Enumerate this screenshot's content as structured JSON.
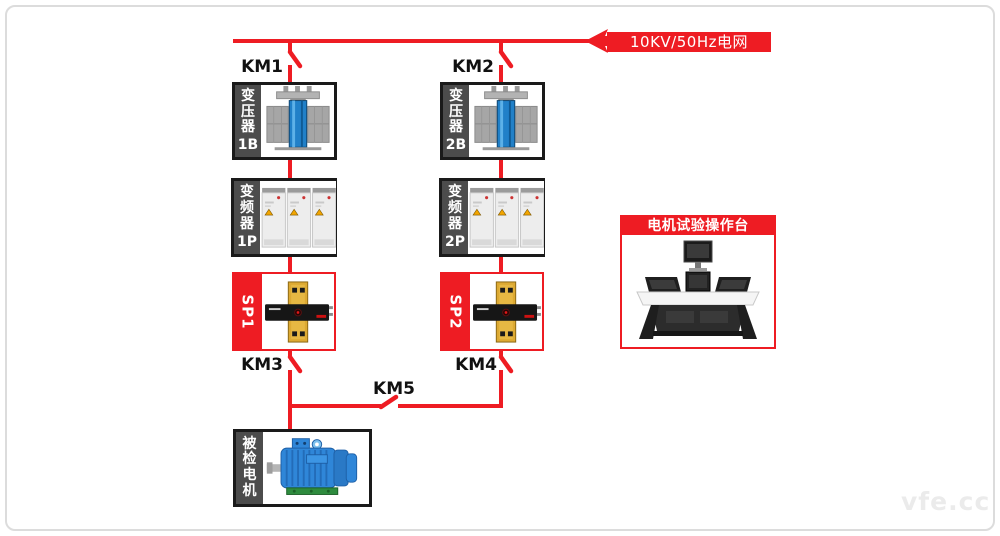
{
  "colors": {
    "accent_red": "#ee1c23",
    "box_border_dark": "#1a1a1a",
    "sidebar_gray": "#4c4c4c"
  },
  "grid_source": {
    "label": "10KV/50Hz电网"
  },
  "branches": [
    {
      "breaker_top": "KM1",
      "transformer": {
        "name": "变压器",
        "code": "1B"
      },
      "inverter": {
        "name": "变频器",
        "code": "1P"
      },
      "sensor": {
        "code": "SP1"
      },
      "breaker_bottom": "KM3"
    },
    {
      "breaker_top": "KM2",
      "transformer": {
        "name": "变压器",
        "code": "2B"
      },
      "inverter": {
        "name": "变频器",
        "code": "2P"
      },
      "sensor": {
        "code": "SP2"
      },
      "breaker_bottom": "KM4"
    }
  ],
  "tie_breaker": {
    "label": "KM5"
  },
  "motor_under_test": {
    "label": "被检电机"
  },
  "console": {
    "title": "电机试验操作台"
  },
  "watermark": {
    "text": "vfe.cc"
  }
}
